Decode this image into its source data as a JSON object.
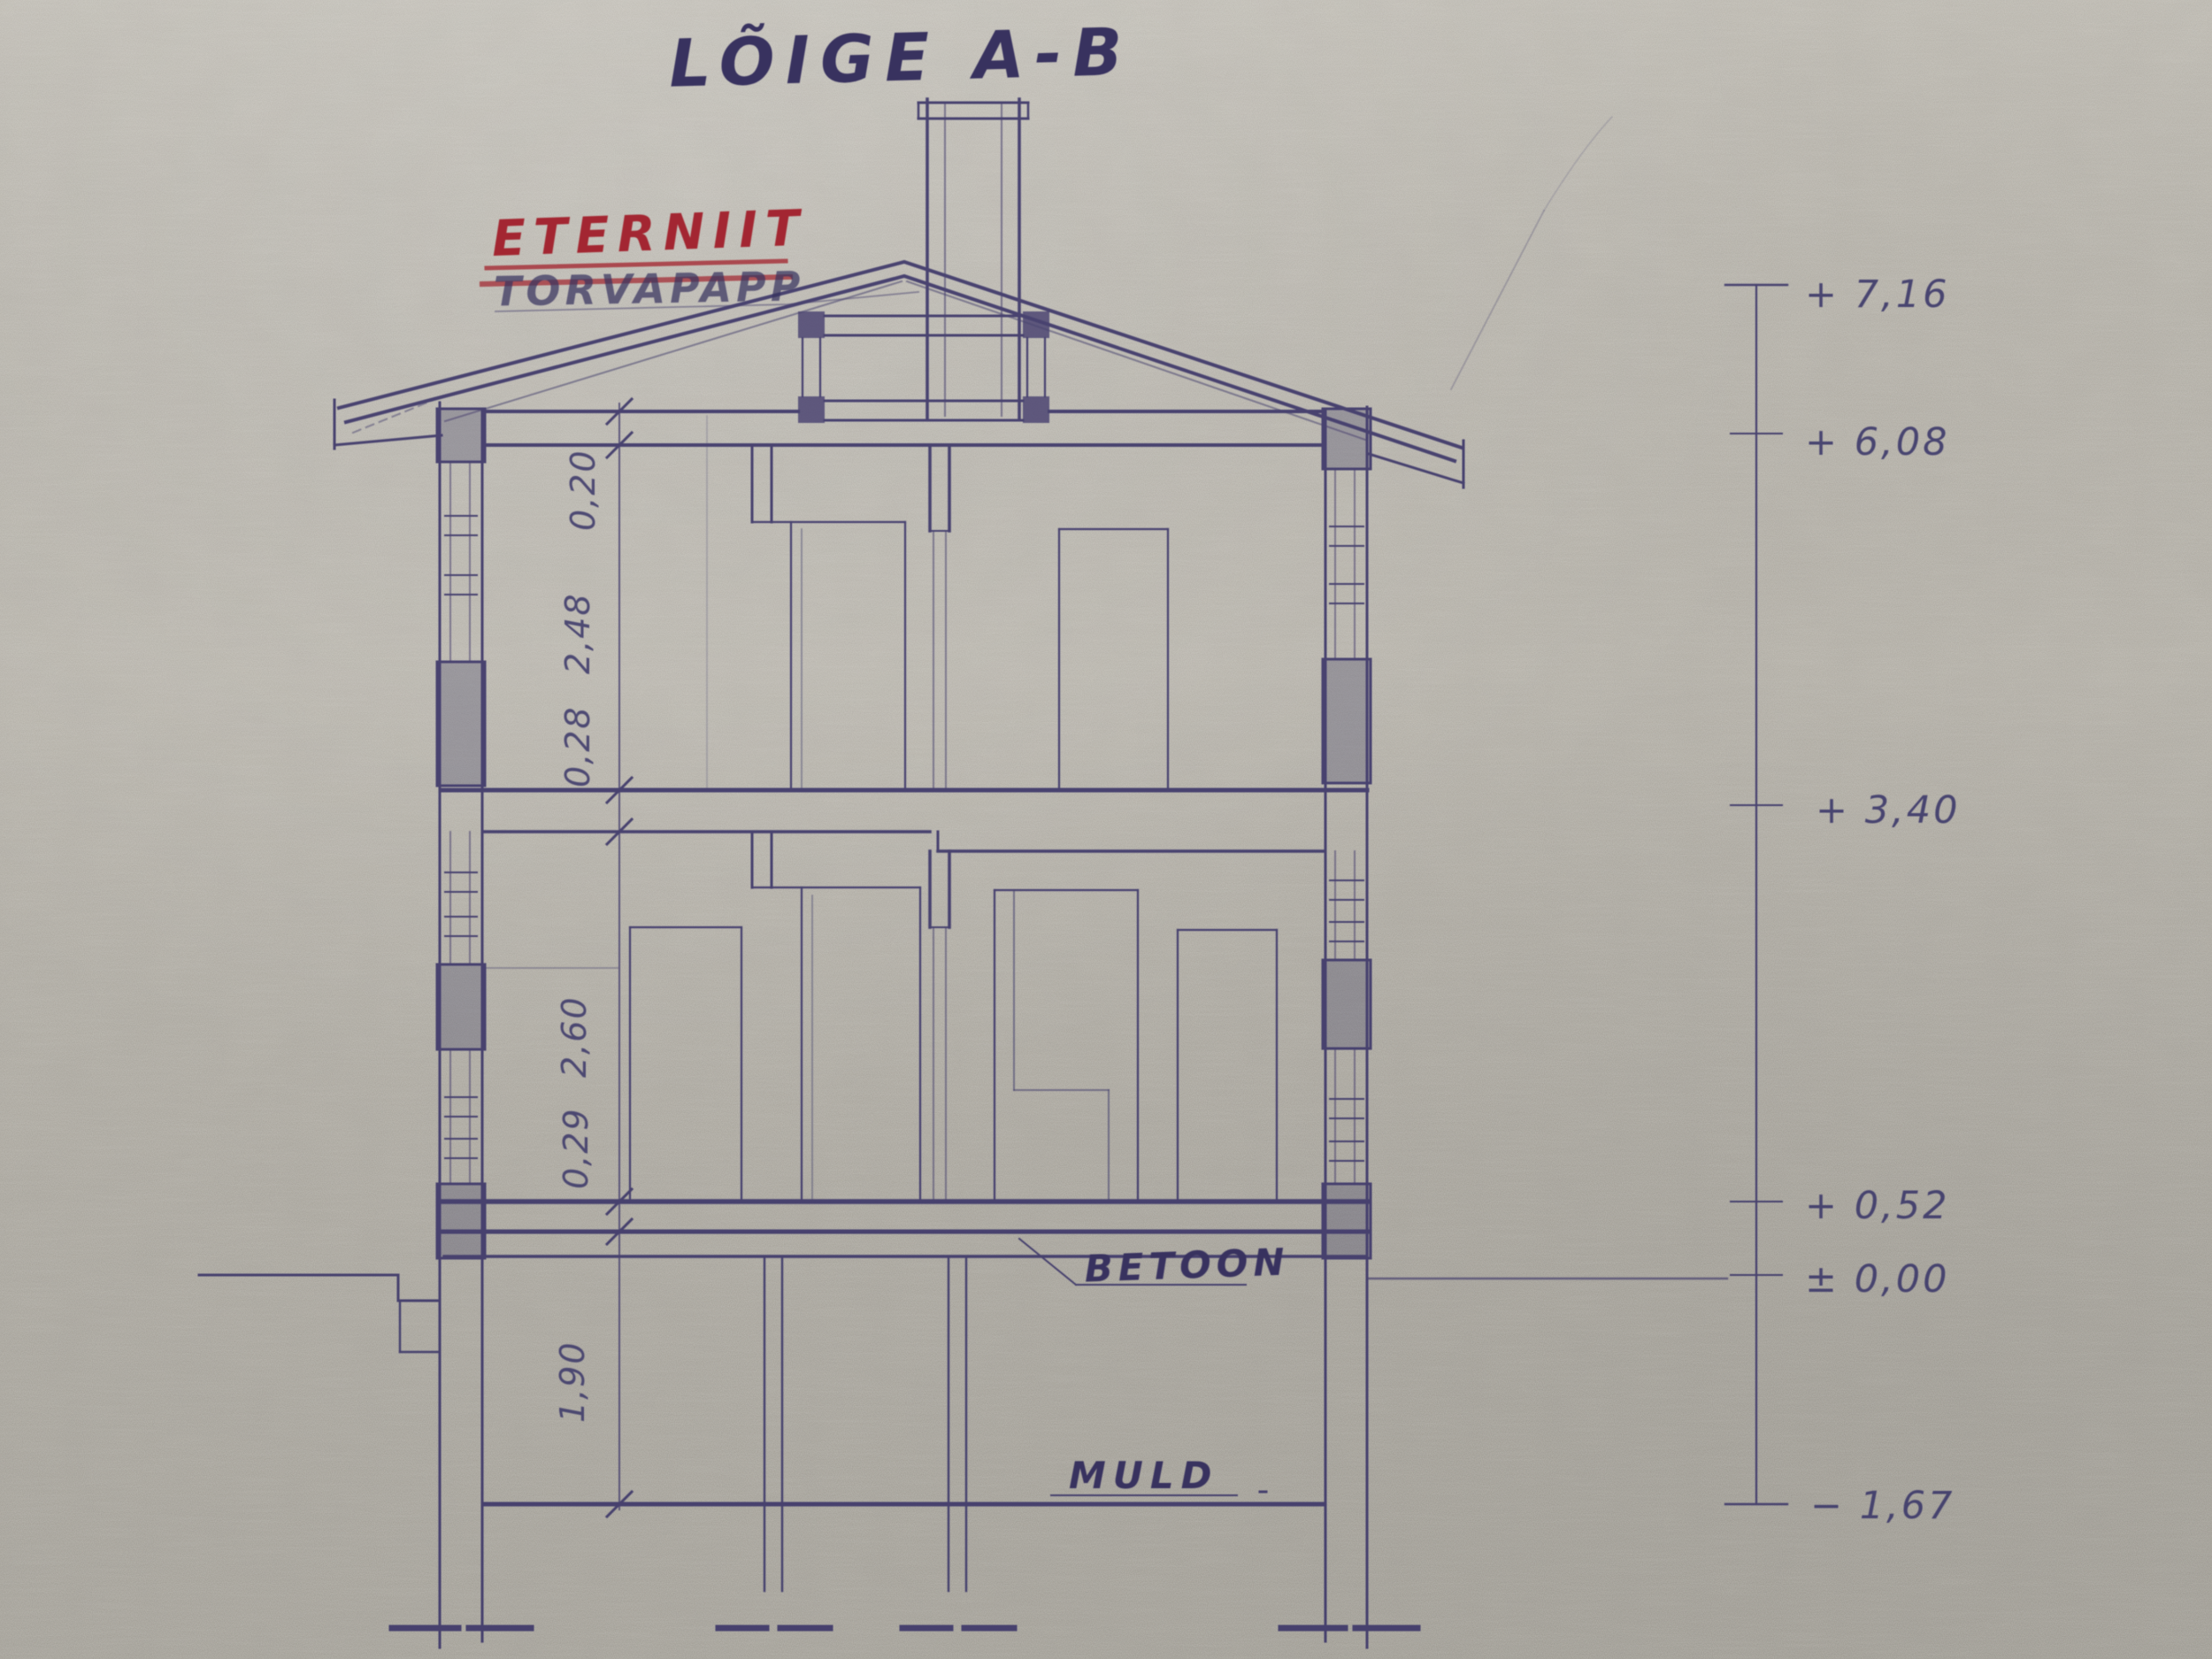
{
  "title": "LÕIGE A-B",
  "labels": {
    "roof_material": "ETERNIIT",
    "replaced_material": "TORVAPAPP",
    "floor_material": "BETOON",
    "soil": "MULD"
  },
  "dimensions_m": [
    "0,20",
    "2,48",
    "0,28",
    "2,60",
    "0,29",
    "1,90"
  ],
  "elevations_m": [
    "+ 7,16",
    "+ 6,08",
    "+ 3,40",
    "+ 0,52",
    "± 0,00",
    "− 1,67"
  ],
  "colors": {
    "paper": "#b2aea5",
    "ink": "#3b3568",
    "red_ink": "#a32730"
  }
}
